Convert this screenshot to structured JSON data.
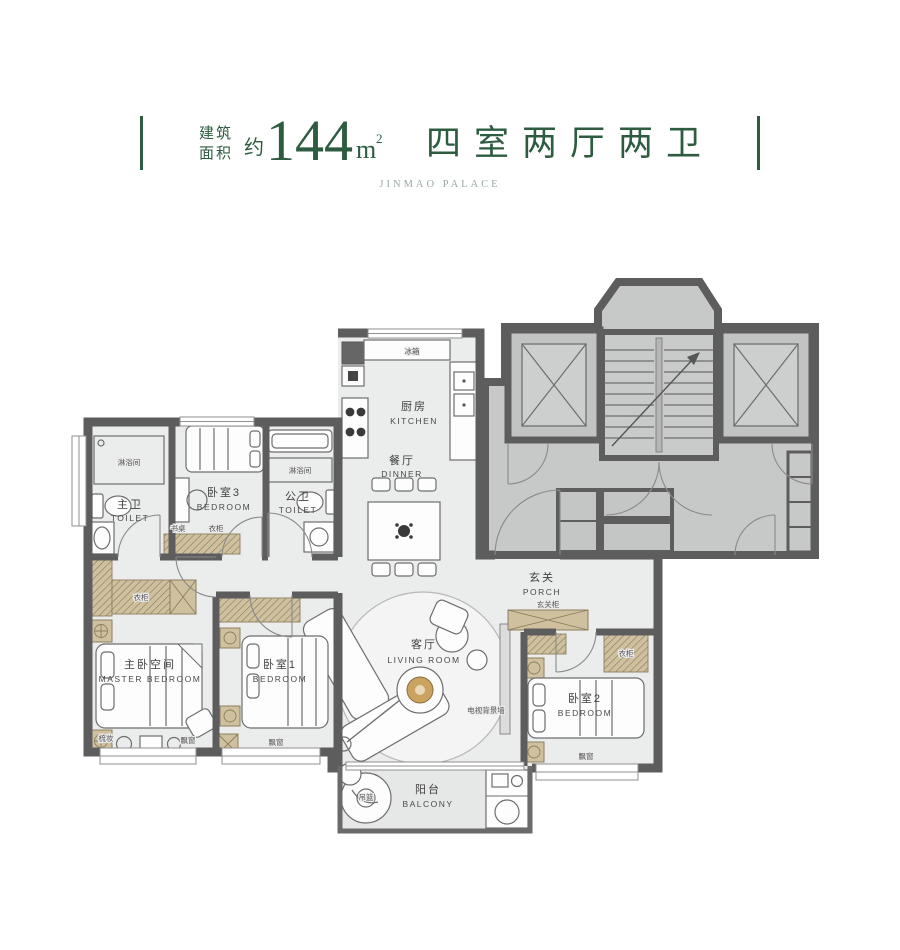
{
  "header": {
    "area_prefix_line1": "建筑",
    "area_prefix_line2": "面积",
    "approx": "约",
    "area_value": "144",
    "area_unit_base": "m",
    "area_unit_exponent": "2",
    "layout_text": "四室两厅两卫",
    "subtitle": "JINMAO PALACE"
  },
  "rooms": {
    "kitchen": {
      "cn": "厨房",
      "en": "KITCHEN"
    },
    "dining": {
      "cn": "餐厅",
      "en": "DINNER"
    },
    "living": {
      "cn": "客厅",
      "en": "LIVING ROOM"
    },
    "balcony": {
      "cn": "阳台",
      "en": "BALCONY"
    },
    "porch": {
      "cn": "玄关",
      "en": "PORCH"
    },
    "master_bedroom": {
      "cn": "主卧空间",
      "en": "MASTER BEDROOM"
    },
    "bedroom1": {
      "cn": "卧室1",
      "en": "BEDROOM"
    },
    "bedroom2": {
      "cn": "卧室2",
      "en": "BEDROOM"
    },
    "bedroom3": {
      "cn": "卧室3",
      "en": "BEDROOM"
    },
    "master_toilet": {
      "cn": "主卫",
      "en": "TOILET"
    },
    "public_toilet": {
      "cn": "公卫",
      "en": "TOILET"
    }
  },
  "annotations": {
    "fridge": "冰箱",
    "shower_master": "淋浴间",
    "shower_public": "淋浴间",
    "wardrobe_master": "衣柜",
    "wardrobe_bedroom2": "衣柜",
    "wardrobe_bedroom3": "衣柜",
    "desk_bedroom3": "书桌",
    "dresser_master": "梳妆",
    "bay_window_master": "飘窗",
    "bay_window_bedroom1": "飘窗",
    "bay_window_bedroom2": "飘窗",
    "porch_cabinet": "玄关柜",
    "tv_wall": "电视背景墙",
    "hanging_basket": "吊篮"
  },
  "colors": {
    "accent_green": "#2e5c41",
    "subtitle_gray": "#9aaa9d",
    "wall": "#5d5d5d",
    "unit_floor": "#ebecec",
    "core_floor": "#c7c8c8",
    "wood": "#cfc1a0",
    "label": "#3f3f3f"
  }
}
